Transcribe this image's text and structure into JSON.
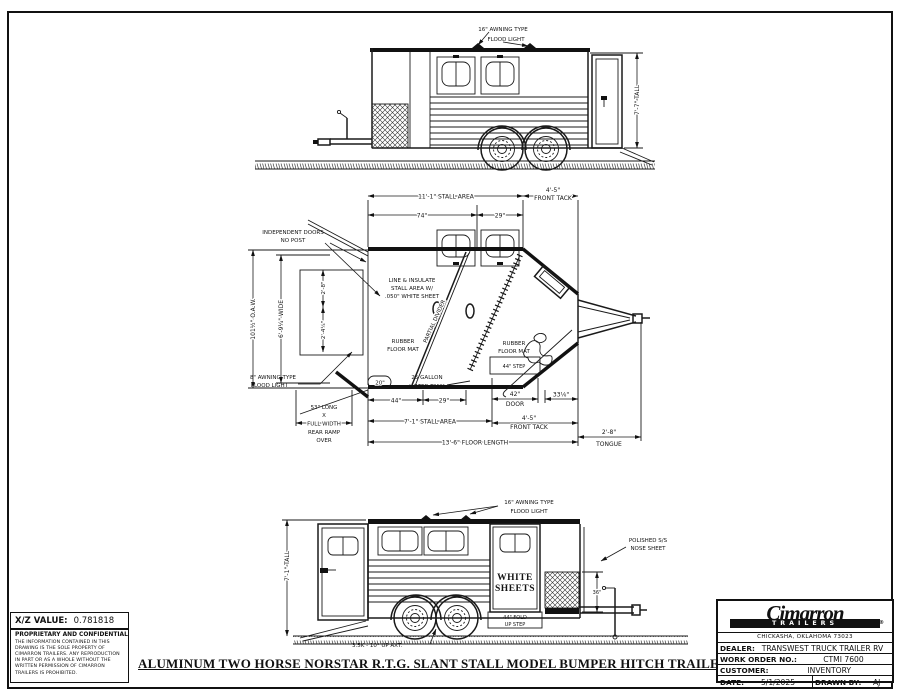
{
  "top_view": {
    "flood_light": [
      "16\" AWNING TYPE",
      "FLOOD LIGHT"
    ],
    "height_dim": "7'-7\" TALL"
  },
  "plan_view": {
    "stall_area_top": "11'-1\" STALL AREA",
    "front_tack_top": [
      "4'-5\"",
      "FRONT TACK"
    ],
    "dim_74": "74\"",
    "dim_29a": "29\"",
    "independent_doors": [
      "INDEPENDENT DOORS",
      "NO POST"
    ],
    "line_insulate": [
      "LINE & INSULATE",
      "STALL AREA W/",
      ".050\" WHITE SHEET"
    ],
    "partial_divider": "PARTIAL DIVIDER",
    "oaw": "101½\" O.A.W.",
    "wide": "6'-9¼\" WIDE",
    "dim_2_8": "2'-8\"",
    "dim_2_4": "2'-4¼\"",
    "rubber_mat_rear": [
      "RUBBER",
      "FLOOR MAT"
    ],
    "awning_light": [
      "8\" AWNING TYPE",
      "FLOOD LIGHT"
    ],
    "rear_ramp": [
      "53\" LONG",
      "X",
      "FULL WIDTH",
      "REAR RAMP",
      "OVER"
    ],
    "dim_20": "20\"",
    "water_tank": [
      "25 GALLON",
      "WATER TANK"
    ],
    "rubber_mat_front": [
      "RUBBER",
      "FLOOR MAT"
    ],
    "step": "44\" STEP",
    "door_42": [
      "42\"",
      "DOOR"
    ],
    "dim_33": "33⅛\"",
    "dim_44": "44\"",
    "dim_29b": "29\"",
    "stall_area_bottom": "7'-1\" STALL AREA",
    "front_tack_bottom": [
      "4'-5\"",
      "FRONT TACK"
    ],
    "floor_length": "13'-6\" FLOOR LENGTH",
    "tongue": [
      "2'-8\"",
      "TONGUE"
    ]
  },
  "side_view": {
    "flood_light": [
      "16\" AWNING TYPE",
      "FLOOD LIGHT"
    ],
    "nose_sheet": [
      "POLISHED S/S",
      "NOSE SHEET"
    ],
    "height_dim": "7'-1\" TALL",
    "white_sheets": [
      "WHITE",
      "SHEETS"
    ],
    "fold_step": [
      "44\" FOLD",
      "UP STEP"
    ],
    "dim_36": "36\"",
    "axle": "3.5K - 10° UP AXT."
  },
  "footer": {
    "title": "ALUMINUM TWO HORSE NORSTAR R.T.G. SLANT STALL MODEL BUMPER HITCH TRAILER"
  },
  "info_box": {
    "xz_label": "X/Z VALUE:",
    "xz_value": "0.781818",
    "confidential_title": "PROPRIETARY AND CONFIDENTIAL",
    "confidential_body": "THE INFORMATION CONTAINED IN THIS DRAWING IS THE SOLE PROPERTY OF CIMARRON TRAILERS. ANY REPRODUCTION IN PART OR AS A WHOLE WITHOUT THE WRITTEN PERMISSION OF CIMARRON TRAILERS IS PROHIBITED."
  },
  "title_block": {
    "brand": "Cimarron",
    "brand_sub": "TRAILERS",
    "reg": "®",
    "address": "CHICKASHA, OKLAHOMA 73023",
    "dealer_label": "DEALER:",
    "dealer_value": "TRANSWEST TRUCK TRAILER RV",
    "order_label": "WORK ORDER NO.:",
    "order_value": "CTMI 7600",
    "customer_label": "CUSTOMER:",
    "customer_value": "INVENTORY",
    "date_label": "DATE:",
    "date_value": "5/1/2025",
    "drawn_label": "DRAWN BY:",
    "drawn_value": "AJ"
  }
}
